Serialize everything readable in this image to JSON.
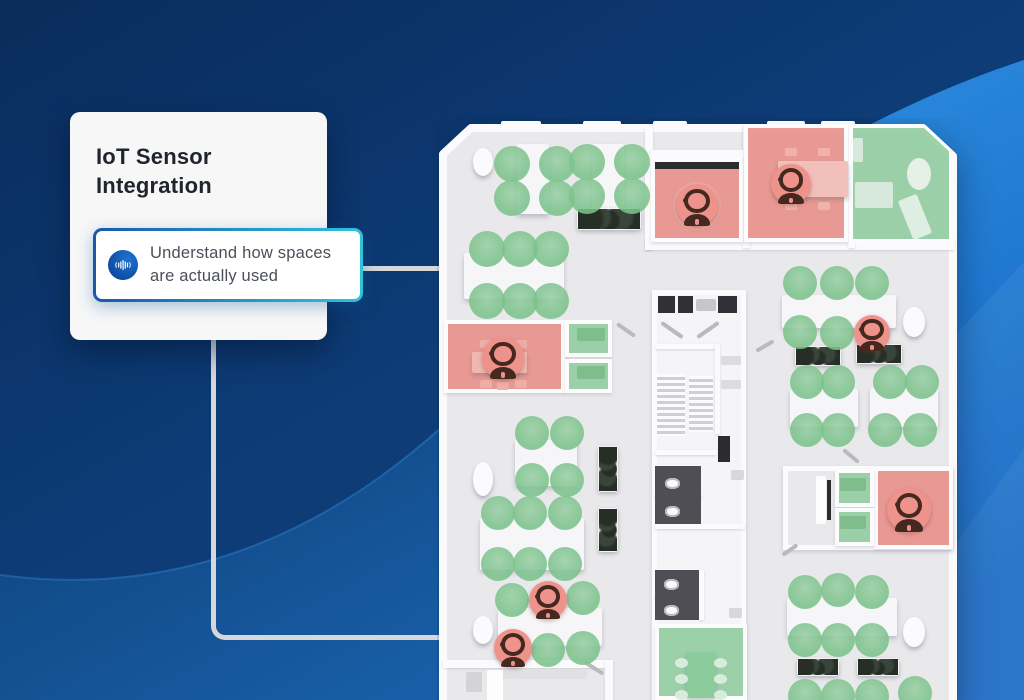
{
  "card": {
    "title": "IoT Sensor Integration",
    "callout": {
      "icon": "audio-waveform-icon",
      "text": "Understand how spaces are actually used"
    }
  },
  "colors": {
    "background_navy": "#0d3c77",
    "accent_blue": "#1a57ab",
    "accent_cyan": "#2fc3dc",
    "bright_swoosh": "#2a87dc",
    "occupied_red": "#e9908a",
    "available_green": "#92cca0",
    "floor_gray": "#e9e9ec",
    "wall_white": "#fbfbfd",
    "connector_gray": "#d6d8da"
  },
  "floorplan": {
    "semantics": {
      "green_circle": "seat available",
      "red_marker": "space occupied by person"
    },
    "elements": [
      {
        "t": "core",
        "x": 215,
        "y": 172,
        "w": 94,
        "h": 410,
        "n": "building-core"
      },
      {
        "t": "block",
        "x": 346,
        "y": 348,
        "w": 170,
        "h": 84,
        "n": "meeting-room-block"
      },
      {
        "t": "wall",
        "x": 208,
        "y": 8,
        "w": 8,
        "h": 124
      },
      {
        "t": "wall",
        "x": 208,
        "y": 122,
        "w": 310,
        "h": 10
      },
      {
        "t": "wall",
        "x": 306,
        "y": 8,
        "w": 7,
        "h": 122
      },
      {
        "t": "wall",
        "x": 411,
        "y": 8,
        "w": 7,
        "h": 122
      },
      {
        "t": "wall",
        "x": 214,
        "y": 32,
        "w": 94,
        "h": 8
      },
      {
        "t": "wall",
        "x": 6,
        "y": 542,
        "w": 168,
        "h": 8
      },
      {
        "t": "wall",
        "x": 168,
        "y": 542,
        "w": 8,
        "h": 42
      },
      {
        "t": "room",
        "s": "occupied",
        "x": 7,
        "y": 202,
        "w": 121,
        "h": 73,
        "n": "meeting-room-occupied"
      },
      {
        "t": "room",
        "s": "available",
        "x": 128,
        "y": 202,
        "w": 47,
        "h": 37,
        "n": "phone-booth-available"
      },
      {
        "t": "room",
        "s": "available",
        "x": 128,
        "y": 241,
        "w": 47,
        "h": 34,
        "n": "phone-booth-available"
      },
      {
        "t": "room",
        "s": "occupied",
        "x": 214,
        "y": 40,
        "w": 92,
        "h": 84,
        "n": "office-occupied"
      },
      {
        "t": "room",
        "s": "occupied",
        "x": 307,
        "y": 6,
        "w": 104,
        "h": 118,
        "n": "office-occupied"
      },
      {
        "t": "room",
        "s": "available",
        "x": 412,
        "y": 6,
        "w": 104,
        "h": 119,
        "clip": "polygon(0 0, 68% 0, 100% 26%, 100% 100%, 0 100%)",
        "n": "lounge-available"
      },
      {
        "t": "room",
        "s": "occupied",
        "x": 437,
        "y": 349,
        "w": 79,
        "h": 82,
        "n": "office-occupied"
      },
      {
        "t": "room",
        "s": "available",
        "x": 398,
        "y": 351,
        "w": 39,
        "h": 38,
        "n": "phone-booth-available"
      },
      {
        "t": "room",
        "s": "available",
        "x": 398,
        "y": 390,
        "w": 39,
        "h": 38,
        "n": "phone-booth-available"
      },
      {
        "t": "room",
        "s": "available",
        "x": 218,
        "y": 506,
        "w": 92,
        "h": 76,
        "n": "meeting-room-available"
      },
      {
        "t": "elevator",
        "x": 221,
        "y": 178,
        "w": 17,
        "h": 17
      },
      {
        "t": "elevator",
        "x": 241,
        "y": 178,
        "w": 15,
        "h": 17
      },
      {
        "t": "elevator",
        "x": 281,
        "y": 178,
        "w": 19,
        "h": 17
      },
      {
        "t": "item",
        "x": 259,
        "y": 181,
        "w": 20,
        "h": 12,
        "c": "#c6c6cb"
      },
      {
        "t": "door",
        "x": 222,
        "y": 210,
        "w": 26,
        "h": 4,
        "r": 35
      },
      {
        "t": "door",
        "x": 258,
        "y": 210,
        "w": 26,
        "h": 4,
        "r": -35
      },
      {
        "t": "wall",
        "x": 218,
        "y": 226,
        "w": 62,
        "h": 5
      },
      {
        "t": "wall",
        "x": 278,
        "y": 226,
        "w": 5,
        "h": 90
      },
      {
        "t": "item",
        "x": 284,
        "y": 238,
        "w": 20,
        "h": 9,
        "c": "#dcdce0"
      },
      {
        "t": "item",
        "x": 284,
        "y": 262,
        "w": 20,
        "h": 9,
        "c": "#dcdce0"
      },
      {
        "t": "stairs",
        "x": 220,
        "y": 256,
        "w": 28,
        "h": 62
      },
      {
        "t": "stairs",
        "x": 252,
        "y": 258,
        "w": 24,
        "h": 56
      },
      {
        "t": "screen",
        "x": 281,
        "y": 318,
        "w": 12,
        "h": 26
      },
      {
        "t": "wall",
        "x": 218,
        "y": 332,
        "w": 62,
        "h": 5
      },
      {
        "t": "darkfloor",
        "x": 218,
        "y": 348,
        "w": 46,
        "h": 58
      },
      {
        "t": "wall",
        "x": 218,
        "y": 376,
        "w": 46,
        "h": 4
      },
      {
        "t": "toilet",
        "x": 228,
        "y": 360,
        "w": 15,
        "h": 11
      },
      {
        "t": "toilet",
        "x": 228,
        "y": 388,
        "w": 15,
        "h": 11
      },
      {
        "t": "item",
        "x": 294,
        "y": 352,
        "w": 13,
        "h": 10,
        "c": "#d8d8dc"
      },
      {
        "t": "wall",
        "x": 218,
        "y": 406,
        "w": 90,
        "h": 5
      },
      {
        "t": "darkfloor",
        "x": 218,
        "y": 452,
        "w": 44,
        "h": 50
      },
      {
        "t": "wall",
        "x": 218,
        "y": 477,
        "w": 44,
        "h": 4
      },
      {
        "t": "toilet",
        "x": 227,
        "y": 461,
        "w": 15,
        "h": 11
      },
      {
        "t": "toilet",
        "x": 227,
        "y": 487,
        "w": 15,
        "h": 11
      },
      {
        "t": "wall",
        "x": 262,
        "y": 452,
        "w": 5,
        "h": 50
      },
      {
        "t": "item",
        "x": 292,
        "y": 490,
        "w": 13,
        "h": 10,
        "c": "#d8d8dc"
      },
      {
        "t": "table",
        "x": 249,
        "y": 534,
        "w": 30,
        "h": 46,
        "c": "#8ccb9b"
      },
      {
        "t": "ellipse",
        "x": 238,
        "y": 540,
        "w": 13,
        "h": 10,
        "c": "#d9ecdc"
      },
      {
        "t": "ellipse",
        "x": 238,
        "y": 556,
        "w": 13,
        "h": 10,
        "c": "#d9ecdc"
      },
      {
        "t": "ellipse",
        "x": 238,
        "y": 572,
        "w": 13,
        "h": 10,
        "c": "#d9ecdc"
      },
      {
        "t": "ellipse",
        "x": 277,
        "y": 540,
        "w": 13,
        "h": 10,
        "c": "#d9ecdc"
      },
      {
        "t": "ellipse",
        "x": 277,
        "y": 556,
        "w": 13,
        "h": 10,
        "c": "#d9ecdc"
      },
      {
        "t": "ellipse",
        "x": 277,
        "y": 572,
        "w": 13,
        "h": 10,
        "c": "#d9ecdc"
      },
      {
        "t": "pouf",
        "x": 36,
        "y": 30,
        "w": 20,
        "h": 28
      },
      {
        "t": "table",
        "x": 80,
        "y": 26,
        "w": 32,
        "h": 70
      },
      {
        "t": "table",
        "x": 155,
        "y": 26,
        "w": 32,
        "h": 66
      },
      {
        "t": "plant",
        "x": 140,
        "y": 90,
        "w": 64,
        "h": 22
      },
      {
        "t": "table",
        "x": 27,
        "y": 135,
        "w": 100,
        "h": 46
      },
      {
        "t": "table",
        "x": 35,
        "y": 234,
        "w": 55,
        "h": 21,
        "c": "#f1b6b0"
      },
      {
        "t": "tround",
        "cx": 66,
        "cy": 241,
        "d": 34,
        "c": "#efb3ac"
      },
      {
        "t": "chair",
        "x": 43,
        "y": 222,
        "w": 12,
        "h": 8,
        "c": "#eeada7"
      },
      {
        "t": "chair",
        "x": 60,
        "y": 219,
        "w": 12,
        "h": 8,
        "c": "#eeada7"
      },
      {
        "t": "chair",
        "x": 78,
        "y": 222,
        "w": 12,
        "h": 8,
        "c": "#eeada7"
      },
      {
        "t": "chair",
        "x": 43,
        "y": 262,
        "w": 12,
        "h": 8,
        "c": "#eeada7"
      },
      {
        "t": "chair",
        "x": 60,
        "y": 264,
        "w": 12,
        "h": 8,
        "c": "#eeada7"
      },
      {
        "t": "chair",
        "x": 78,
        "y": 262,
        "w": 12,
        "h": 8,
        "c": "#eeada7"
      },
      {
        "t": "item",
        "x": 140,
        "y": 210,
        "w": 28,
        "h": 13,
        "c": "#80bd8c"
      },
      {
        "t": "item",
        "x": 140,
        "y": 248,
        "w": 28,
        "h": 13,
        "c": "#80bd8c"
      },
      {
        "t": "screen",
        "x": 218,
        "y": 44,
        "w": 84,
        "h": 7
      },
      {
        "t": "tround",
        "cx": 260,
        "cy": 88,
        "d": 48,
        "c": "#eba9a2"
      },
      {
        "t": "table",
        "x": 341,
        "y": 43,
        "w": 70,
        "h": 36,
        "c": "#f2c0ba"
      },
      {
        "t": "chair",
        "x": 348,
        "y": 30,
        "w": 12,
        "h": 8,
        "c": "#efb2ac"
      },
      {
        "t": "chair",
        "x": 381,
        "y": 30,
        "w": 12,
        "h": 8,
        "c": "#efb2ac"
      },
      {
        "t": "chair",
        "x": 348,
        "y": 84,
        "w": 12,
        "h": 8,
        "c": "#efb2ac"
      },
      {
        "t": "chair",
        "x": 381,
        "y": 84,
        "w": 12,
        "h": 8,
        "c": "#efb2ac"
      },
      {
        "t": "item",
        "x": 416,
        "y": 20,
        "w": 10,
        "h": 24,
        "c": "#d7e9db"
      },
      {
        "t": "item",
        "x": 418,
        "y": 64,
        "w": 38,
        "h": 26,
        "c": "#d7e9db"
      },
      {
        "t": "ellipse",
        "x": 470,
        "y": 40,
        "w": 24,
        "h": 32,
        "c": "#e6f0e7"
      },
      {
        "t": "item",
        "x": 468,
        "y": 78,
        "w": 20,
        "h": 42,
        "c": "#dfeee2",
        "r": -22
      },
      {
        "t": "table",
        "x": 345,
        "y": 177,
        "w": 114,
        "h": 33
      },
      {
        "t": "pouf",
        "x": 466,
        "y": 189,
        "w": 22,
        "h": 30
      },
      {
        "t": "plant",
        "x": 358,
        "y": 228,
        "w": 46,
        "h": 20
      },
      {
        "t": "plant",
        "x": 419,
        "y": 226,
        "w": 46,
        "h": 20
      },
      {
        "t": "table",
        "x": 353,
        "y": 271,
        "w": 68,
        "h": 38
      },
      {
        "t": "table",
        "x": 433,
        "y": 270,
        "w": 68,
        "h": 39
      },
      {
        "t": "item",
        "x": 379,
        "y": 358,
        "w": 10,
        "h": 48,
        "c": "#fdfdfe"
      },
      {
        "t": "screen",
        "x": 390,
        "y": 362,
        "w": 4,
        "h": 40
      },
      {
        "t": "item",
        "x": 403,
        "y": 360,
        "w": 26,
        "h": 13,
        "c": "#80bd8c"
      },
      {
        "t": "item",
        "x": 403,
        "y": 398,
        "w": 26,
        "h": 13,
        "c": "#80bd8c"
      },
      {
        "t": "tround",
        "cx": 472,
        "cy": 400,
        "d": 32,
        "c": "#eba9a2"
      },
      {
        "t": "table",
        "x": 350,
        "y": 480,
        "w": 110,
        "h": 38
      },
      {
        "t": "pouf",
        "x": 466,
        "y": 499,
        "w": 22,
        "h": 30
      },
      {
        "t": "plant",
        "x": 360,
        "y": 540,
        "w": 42,
        "h": 18
      },
      {
        "t": "plant",
        "x": 420,
        "y": 540,
        "w": 42,
        "h": 18
      },
      {
        "t": "item",
        "x": 50,
        "y": 552,
        "w": 16,
        "h": 40,
        "c": "#fdfdfe"
      },
      {
        "t": "item",
        "x": 66,
        "y": 552,
        "w": 84,
        "h": 9,
        "c": "#e0e1e4"
      },
      {
        "t": "item",
        "x": 29,
        "y": 554,
        "w": 16,
        "h": 20,
        "c": "#d4d4d8"
      },
      {
        "t": "door",
        "x": 146,
        "y": 548,
        "w": 22,
        "h": 4,
        "r": 32
      },
      {
        "t": "table",
        "x": 78,
        "y": 322,
        "w": 62,
        "h": 46
      },
      {
        "t": "pouf",
        "x": 36,
        "y": 344,
        "w": 20,
        "h": 34
      },
      {
        "t": "plant",
        "x": 161,
        "y": 328,
        "w": 20,
        "h": 46,
        "v": true
      },
      {
        "t": "table",
        "x": 43,
        "y": 400,
        "w": 104,
        "h": 52
      },
      {
        "t": "plant",
        "x": 161,
        "y": 390,
        "w": 20,
        "h": 44,
        "v": true
      },
      {
        "t": "table",
        "x": 61,
        "y": 490,
        "w": 104,
        "h": 38
      },
      {
        "t": "pouf",
        "x": 36,
        "y": 498,
        "w": 20,
        "h": 28
      },
      {
        "t": "door",
        "x": 178,
        "y": 210,
        "w": 22,
        "h": 4,
        "r": 35
      },
      {
        "t": "door",
        "x": 318,
        "y": 226,
        "w": 20,
        "h": 4,
        "r": -30
      },
      {
        "t": "door",
        "x": 404,
        "y": 336,
        "w": 20,
        "h": 4,
        "r": 40
      },
      {
        "t": "door",
        "x": 344,
        "y": 430,
        "w": 18,
        "h": 4,
        "r": -35
      },
      {
        "t": "seat",
        "cx": 75,
        "cy": 46,
        "d": 36
      },
      {
        "t": "seat",
        "cx": 120,
        "cy": 46,
        "d": 36
      },
      {
        "t": "seat",
        "cx": 75,
        "cy": 80,
        "d": 36
      },
      {
        "t": "seat",
        "cx": 120,
        "cy": 80,
        "d": 36
      },
      {
        "t": "seat",
        "cx": 150,
        "cy": 44,
        "d": 36
      },
      {
        "t": "seat",
        "cx": 195,
        "cy": 44,
        "d": 36
      },
      {
        "t": "seat",
        "cx": 150,
        "cy": 78,
        "d": 36
      },
      {
        "t": "seat",
        "cx": 195,
        "cy": 78,
        "d": 36
      },
      {
        "t": "seat",
        "cx": 50,
        "cy": 131,
        "d": 36
      },
      {
        "t": "seat",
        "cx": 83,
        "cy": 131,
        "d": 36
      },
      {
        "t": "seat",
        "cx": 114,
        "cy": 131,
        "d": 36
      },
      {
        "t": "seat",
        "cx": 50,
        "cy": 183,
        "d": 36
      },
      {
        "t": "seat",
        "cx": 83,
        "cy": 183,
        "d": 36
      },
      {
        "t": "seat",
        "cx": 114,
        "cy": 183,
        "d": 36
      },
      {
        "t": "seat",
        "cx": 363,
        "cy": 165,
        "d": 34
      },
      {
        "t": "seat",
        "cx": 400,
        "cy": 165,
        "d": 34
      },
      {
        "t": "seat",
        "cx": 435,
        "cy": 165,
        "d": 34
      },
      {
        "t": "seat",
        "cx": 363,
        "cy": 214,
        "d": 34
      },
      {
        "t": "seat",
        "cx": 400,
        "cy": 215,
        "d": 34
      },
      {
        "t": "seat",
        "cx": 370,
        "cy": 264,
        "d": 34
      },
      {
        "t": "seat",
        "cx": 401,
        "cy": 264,
        "d": 34
      },
      {
        "t": "seat",
        "cx": 370,
        "cy": 312,
        "d": 34
      },
      {
        "t": "seat",
        "cx": 401,
        "cy": 312,
        "d": 34
      },
      {
        "t": "seat",
        "cx": 453,
        "cy": 264,
        "d": 34
      },
      {
        "t": "seat",
        "cx": 485,
        "cy": 264,
        "d": 34
      },
      {
        "t": "seat",
        "cx": 448,
        "cy": 312,
        "d": 34
      },
      {
        "t": "seat",
        "cx": 483,
        "cy": 312,
        "d": 34
      },
      {
        "t": "seat",
        "cx": 368,
        "cy": 474,
        "d": 34
      },
      {
        "t": "seat",
        "cx": 401,
        "cy": 472,
        "d": 34
      },
      {
        "t": "seat",
        "cx": 435,
        "cy": 474,
        "d": 34
      },
      {
        "t": "seat",
        "cx": 368,
        "cy": 522,
        "d": 34
      },
      {
        "t": "seat",
        "cx": 401,
        "cy": 522,
        "d": 34
      },
      {
        "t": "seat",
        "cx": 435,
        "cy": 522,
        "d": 34
      },
      {
        "t": "seat",
        "cx": 368,
        "cy": 578,
        "d": 34
      },
      {
        "t": "seat",
        "cx": 401,
        "cy": 578,
        "d": 34
      },
      {
        "t": "seat",
        "cx": 435,
        "cy": 578,
        "d": 34
      },
      {
        "t": "seat",
        "cx": 478,
        "cy": 575,
        "d": 34
      },
      {
        "t": "seat",
        "cx": 95,
        "cy": 315,
        "d": 34
      },
      {
        "t": "seat",
        "cx": 130,
        "cy": 315,
        "d": 34
      },
      {
        "t": "seat",
        "cx": 95,
        "cy": 362,
        "d": 34
      },
      {
        "t": "seat",
        "cx": 130,
        "cy": 362,
        "d": 34
      },
      {
        "t": "seat",
        "cx": 61,
        "cy": 395,
        "d": 34
      },
      {
        "t": "seat",
        "cx": 93,
        "cy": 395,
        "d": 34
      },
      {
        "t": "seat",
        "cx": 128,
        "cy": 395,
        "d": 34
      },
      {
        "t": "seat",
        "cx": 61,
        "cy": 446,
        "d": 34
      },
      {
        "t": "seat",
        "cx": 93,
        "cy": 446,
        "d": 34
      },
      {
        "t": "seat",
        "cx": 128,
        "cy": 446,
        "d": 34
      },
      {
        "t": "seat",
        "cx": 75,
        "cy": 482,
        "d": 34
      },
      {
        "t": "seat",
        "cx": 146,
        "cy": 480,
        "d": 34
      },
      {
        "t": "seat",
        "cx": 111,
        "cy": 532,
        "d": 34
      },
      {
        "t": "seat",
        "cx": 146,
        "cy": 530,
        "d": 34
      },
      {
        "t": "person",
        "cx": 66,
        "cy": 240,
        "d": 42
      },
      {
        "t": "person",
        "cx": 260,
        "cy": 87,
        "d": 42
      },
      {
        "t": "person",
        "cx": 354,
        "cy": 66,
        "d": 40
      },
      {
        "t": "person",
        "cx": 435,
        "cy": 215,
        "d": 36
      },
      {
        "t": "person",
        "cx": 472,
        "cy": 392,
        "d": 44
      },
      {
        "t": "person",
        "cx": 111,
        "cy": 482,
        "d": 38
      },
      {
        "t": "person",
        "cx": 76,
        "cy": 530,
        "d": 38
      }
    ]
  }
}
